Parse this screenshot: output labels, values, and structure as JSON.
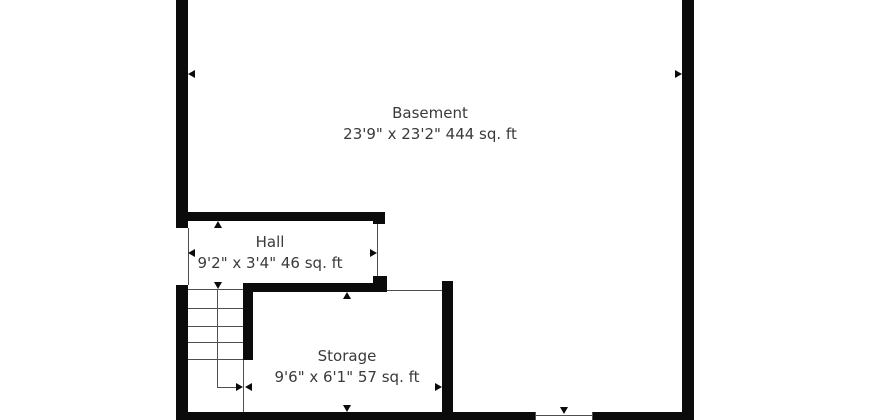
{
  "floorplan": {
    "rooms": [
      {
        "name": "Basement",
        "dimensions": "23'9\" x 23'2\" 444 sq. ft"
      },
      {
        "name": "Hall",
        "dimensions": "9'2\" x 3'4\" 46 sq. ft"
      },
      {
        "name": "Storage",
        "dimensions": "9'6\" x 6'1\" 57 sq. ft"
      }
    ],
    "stairs": {
      "tread_count": 5
    },
    "colors": {
      "wall": "#0b0b0b",
      "thin_line": "#4f4f4f",
      "text": "#3a3a3a",
      "background": "#ffffff"
    }
  }
}
